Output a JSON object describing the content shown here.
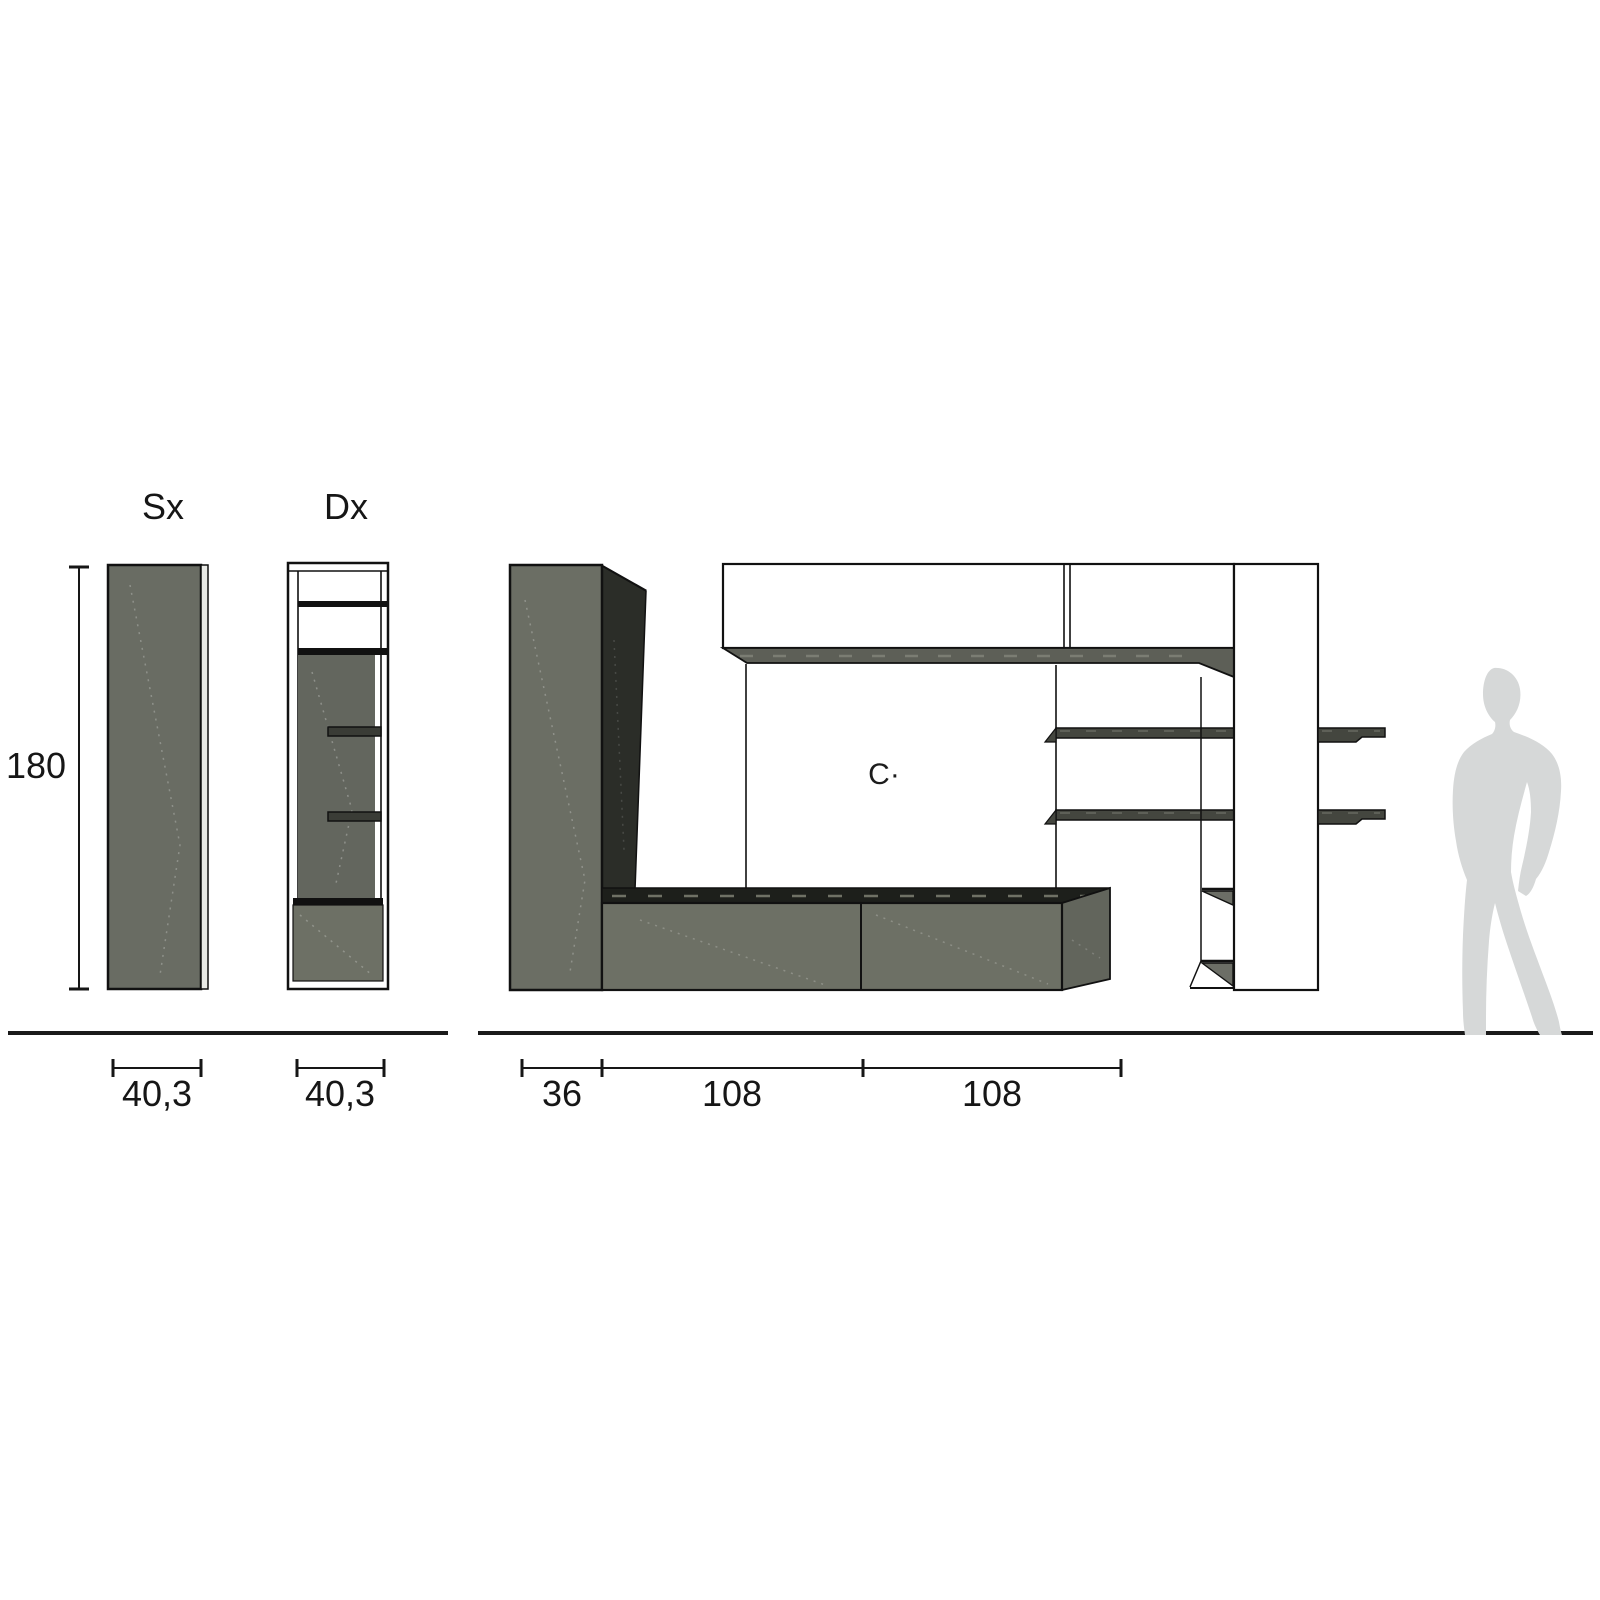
{
  "diagram": {
    "type": "wall-unit-dimension-drawing",
    "side_views": {
      "sx_label": "Sx",
      "dx_label": "Dx",
      "height_dimension": "180",
      "sx_width_dimension": "40,3",
      "dx_width_dimension": "40,3"
    },
    "front_view": {
      "depth_dimension": "36",
      "segment1_dimension": "108",
      "segment2_dimension": "108",
      "wall_mark": "C·"
    },
    "colors": {
      "panel_gray": "#6b6e64",
      "panel_dark_side": "#2b2d28",
      "base_top_black": "#1d1f1b",
      "shelf_dark": "#44463f",
      "underside_gray": "#5d5f57",
      "silhouette_gray": "#d6d8d8",
      "line_black": "#161616"
    }
  }
}
